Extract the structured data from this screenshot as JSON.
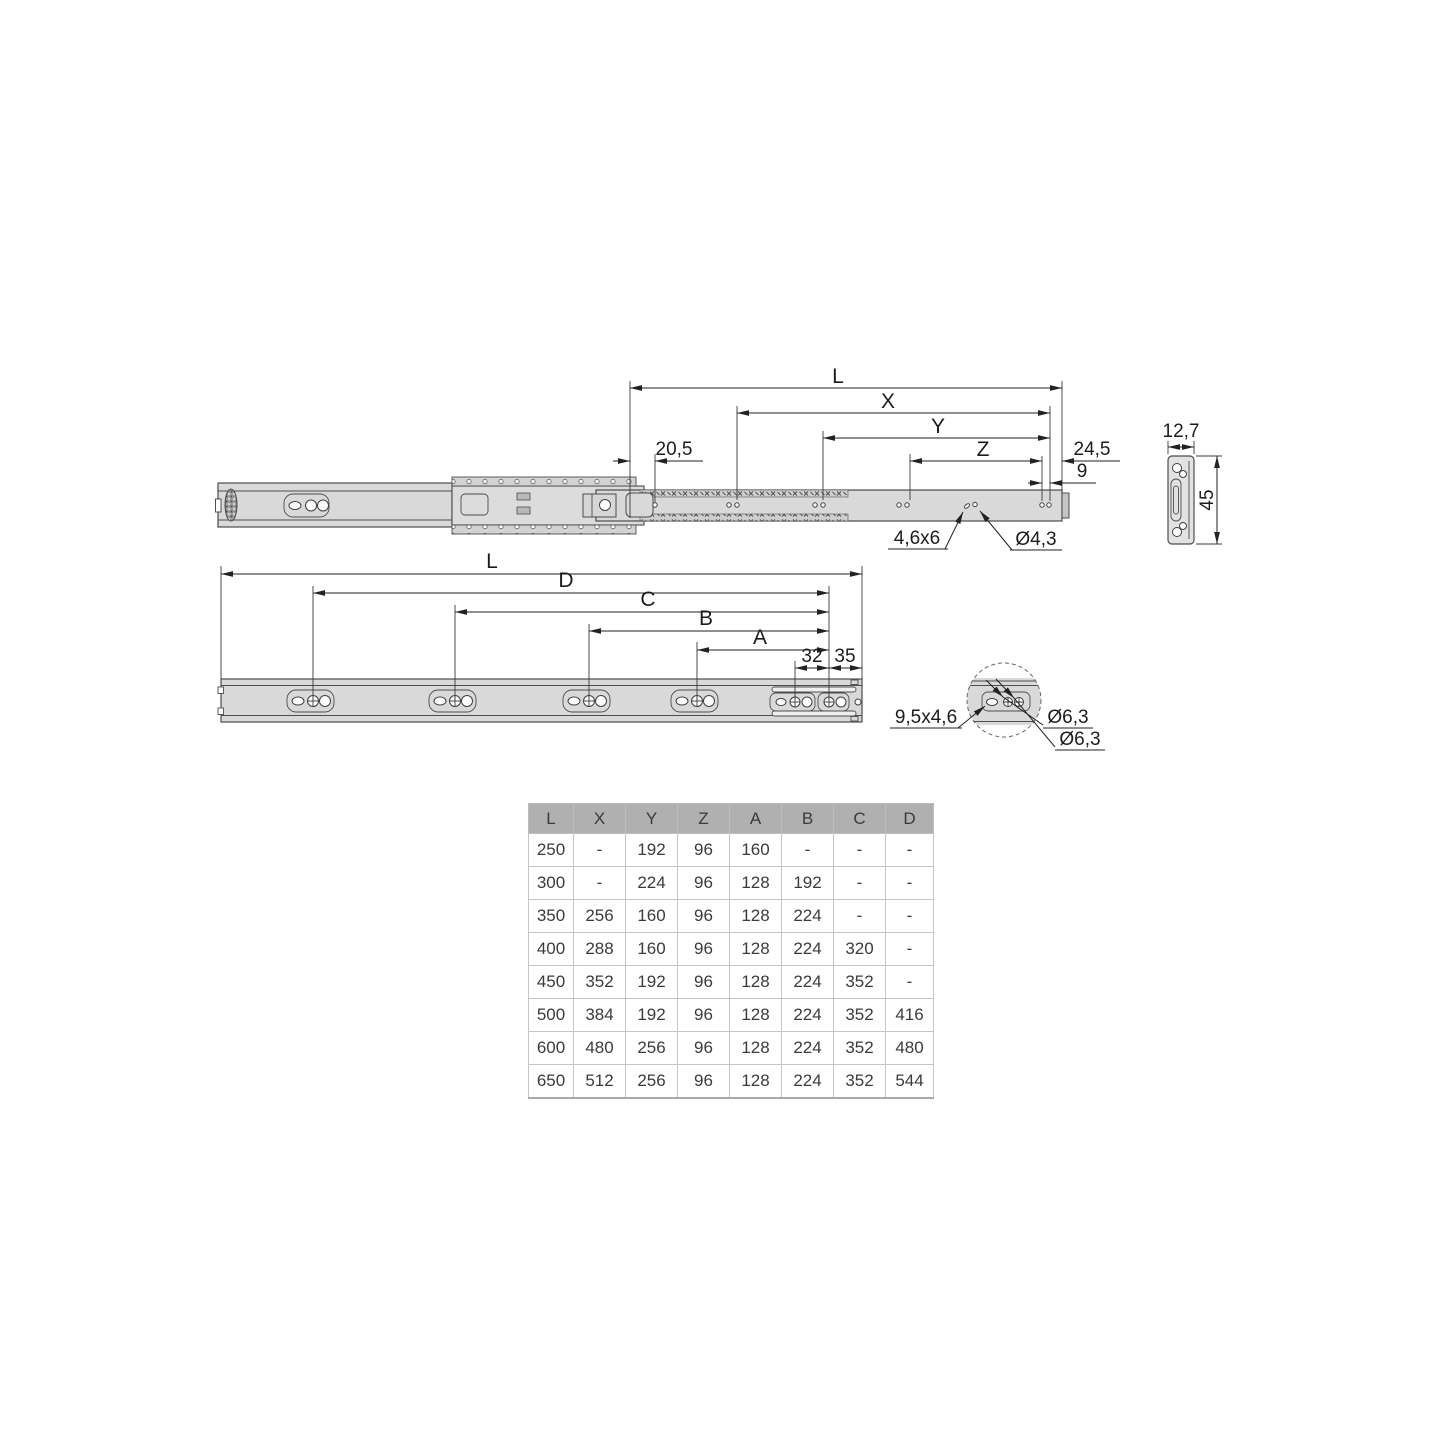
{
  "colors": {
    "background": "#ffffff",
    "rail_fill": "#d9d9d9",
    "outline": "#4d4d4d",
    "dimension_lines": "#222222",
    "table_header_bg": "#b0b0b0",
    "table_border": "#c5c5c5",
    "table_text": "#3b3b3b"
  },
  "extended_view": {
    "labels": {
      "length": "L",
      "x": "X",
      "y": "Y",
      "z": "Z",
      "front_offset": "20,5",
      "rear_offset": "24,5",
      "hole_pitch": "9",
      "slot_size": "4,6x6",
      "hole_dia": "Ø4,3"
    }
  },
  "cross_section": {
    "labels": {
      "width": "12,7",
      "height": "45"
    }
  },
  "closed_view": {
    "labels": {
      "length": "L",
      "d": "D",
      "c": "C",
      "b": "B",
      "a": "A",
      "pitch": "32",
      "end_offset": "35"
    }
  },
  "detail_view": {
    "labels": {
      "slot_size": "9,5x4,6",
      "hole_dia_top": "Ø6,3",
      "hole_dia_bottom": "Ø6,3"
    }
  },
  "table": {
    "headers": [
      "L",
      "X",
      "Y",
      "Z",
      "A",
      "B",
      "C",
      "D"
    ],
    "rows": [
      [
        "250",
        "-",
        "192",
        "96",
        "160",
        "-",
        "-",
        "-"
      ],
      [
        "300",
        "-",
        "224",
        "96",
        "128",
        "192",
        "-",
        "-"
      ],
      [
        "350",
        "256",
        "160",
        "96",
        "128",
        "224",
        "-",
        "-"
      ],
      [
        "400",
        "288",
        "160",
        "96",
        "128",
        "224",
        "320",
        "-"
      ],
      [
        "450",
        "352",
        "192",
        "96",
        "128",
        "224",
        "352",
        "-"
      ],
      [
        "500",
        "384",
        "192",
        "96",
        "128",
        "224",
        "352",
        "416"
      ],
      [
        "600",
        "480",
        "256",
        "96",
        "128",
        "224",
        "352",
        "480"
      ],
      [
        "650",
        "512",
        "256",
        "96",
        "128",
        "224",
        "352",
        "544"
      ]
    ]
  }
}
